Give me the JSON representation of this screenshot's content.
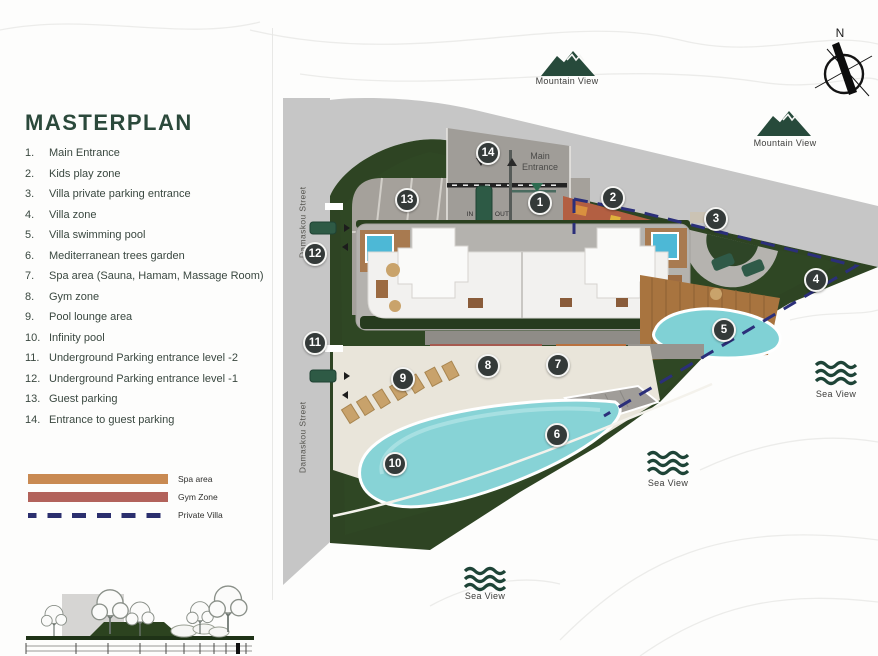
{
  "title": "MASTERPLAN",
  "legend_items": [
    {
      "num": "1.",
      "label": "Main Entrance"
    },
    {
      "num": "2.",
      "label": "Kids play zone"
    },
    {
      "num": "3.",
      "label": "Villa private parking entrance"
    },
    {
      "num": "4.",
      "label": "Villa zone"
    },
    {
      "num": "5.",
      "label": "Villa swimming pool"
    },
    {
      "num": "6.",
      "label": "Mediterranean trees garden"
    },
    {
      "num": "7.",
      "label": "Spa area (Sauna, Hamam, Massage Room)"
    },
    {
      "num": "8.",
      "label": "Gym zone"
    },
    {
      "num": "9.",
      "label": "Pool lounge area"
    },
    {
      "num": "10.",
      "label": "Infinity pool"
    },
    {
      "num": "11.",
      "label": "Underground Parking entrance level -2"
    },
    {
      "num": "12.",
      "label": "Underground Parking entrance level -1"
    },
    {
      "num": "13.",
      "label": "Guest parking"
    },
    {
      "num": "14.",
      "label": "Entrance to guest parking"
    }
  ],
  "zone_legend": [
    {
      "label": "Spa area",
      "color": "#c98a52",
      "style": "solid"
    },
    {
      "label": "Gym Zone",
      "color": "#b2625b",
      "style": "solid"
    },
    {
      "label": "Private Villa",
      "color": "#2b2f6e",
      "style": "dashed"
    }
  ],
  "map_labels": {
    "main_entrance": "Main Entrance",
    "street": "Damaskou Street",
    "mountain_view": "Mountain View",
    "sea_view": "Sea View",
    "north": "N",
    "gate_in": "IN",
    "gate_out": "OUT"
  },
  "markers": [
    "1",
    "2",
    "3",
    "4",
    "5",
    "6",
    "7",
    "8",
    "9",
    "10",
    "11",
    "12",
    "13",
    "14"
  ],
  "colors": {
    "brand_green": "#2d4a3c",
    "marker_bg": "#343a39",
    "road_gray": "#c6c6c6",
    "grass_green": "#2e4423",
    "pool_cyan": "#87d3d6",
    "spa_orange": "#c98a52",
    "gym_red": "#b2625b",
    "villa_boundary_navy": "#2b2f6e"
  }
}
